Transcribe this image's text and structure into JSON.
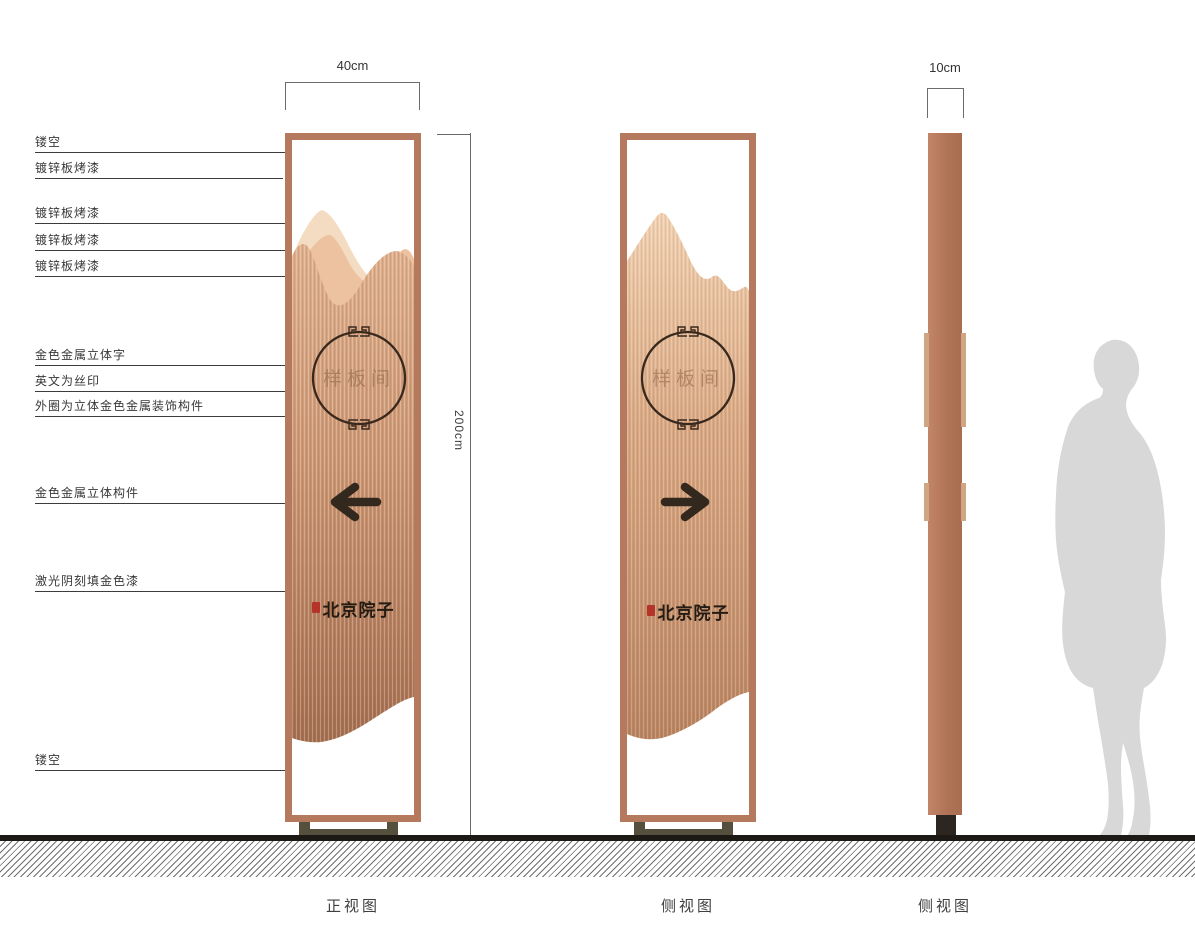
{
  "dimensions": {
    "front_width": "40cm",
    "profile_width": "10cm",
    "height": "200cm"
  },
  "callouts": [
    {
      "label": "镂空"
    },
    {
      "label": "镀锌板烤漆"
    },
    {
      "label": "镀锌板烤漆"
    },
    {
      "label": "镀锌板烤漆"
    },
    {
      "label": "镀锌板烤漆"
    },
    {
      "label": "金色金属立体字"
    },
    {
      "label": "英文为丝印"
    },
    {
      "label": "外圈为立体金色金属装饰构件"
    },
    {
      "label": "金色金属立体构件"
    },
    {
      "label": "激光阴刻填金色漆"
    },
    {
      "label": "镂空"
    }
  ],
  "panel": {
    "room_label": "样板间",
    "brand": "北京院子"
  },
  "captions": {
    "front": "正视图",
    "side": "侧视图",
    "profile": "侧视图"
  },
  "colors": {
    "frame_copper": "#b5795e",
    "body_light": "#f2d4b5",
    "body_dark": "#a56e50",
    "arrow_dark": "#33281e",
    "seal_red": "#b5342a",
    "base_olive": "#55503e",
    "silhouette_gray": "#d8d8d8"
  }
}
